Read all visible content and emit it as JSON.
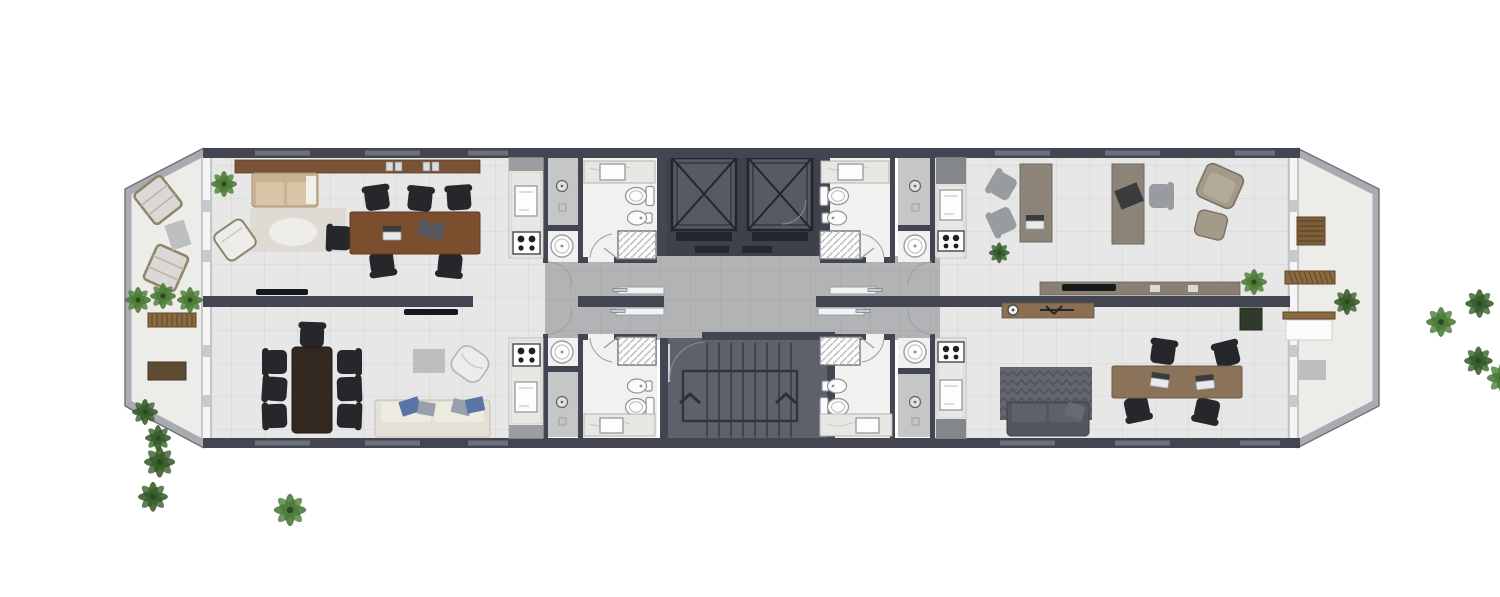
{
  "page": {
    "background": "#ffffff",
    "description": "Architectural floor plan: elongated storey with four furnished units, central double elevator core, stairwell, shared corridor with sliding entry doors, wet cores (kitchenettes, showers, WCs) flanking the core, and chamfered open terraces at both ends."
  },
  "colors": {
    "wall": "#434650",
    "wall_window": "#6d717c",
    "unit_floor": "#e6e7e6",
    "wet_floor": "#f1f1f0",
    "wet_gray": "#c5c6c6",
    "corridor_floor": "#b1b3b5",
    "terrace_floor": "#ecece9",
    "parapet": "#a9abb0",
    "parapet_edge": "#6e7076",
    "core_bg": "#3e414a",
    "cab_fill": "#575a63",
    "cab_line": "#23252c",
    "stair_bg": "#5e616b",
    "stair_line": "#3a3c44",
    "glazing": "#f5f5f5",
    "glazing_frame": "#9b9da2",
    "marble": "#e9e7e3",
    "marble_vein": "#c9c7c3",
    "fixture": "#fcfcfc",
    "fixture_line": "#8f9298",
    "shelf_wood": "#7a5336",
    "table_wood": "#7b4f2e",
    "dining_wood": "#332820",
    "desk_graywood": "#8d8478",
    "desk_tan": "#8a7358",
    "console_wood": "#8a6f52",
    "credenza_wood": "#8a8072",
    "terrace_wood": "#7d5e3b",
    "bench_wood": "#8a6a42",
    "chair_black": "#26272b",
    "chair_gray": "#989ba0",
    "sofa_beige": "#c9b293",
    "sofa_beige_cushion": "#d8c5a6",
    "sofa_cream": "#e3e1d6",
    "sofa_cream_cushion": "#edebe0",
    "sofa_gray": "#53565d",
    "sofa_gray_cushion": "#5e6168",
    "pillow_blue": "#5b74a8",
    "pillow_gray": "#9aa0ab",
    "armchair_white": "#ececeb",
    "rug_light": "#dcd9d2",
    "rug_fluffy": "#efede7",
    "rug_chevron": "#63666e",
    "rug_chevron_line": "#50535a",
    "mat_gray": "#bcbec0",
    "tv_black": "#17181b",
    "plant_green": "#4e7d3a",
    "plant_dark": "#3a5f2e",
    "door_leaf": "#f2f3f4",
    "door_arc": "#9aa0a6",
    "sill_dark": "#26282f",
    "laptop_body": "#e8e9ea",
    "laptop_screen": "#3a3c40"
  },
  "zones": {
    "left_terrace": {
      "label": "left-terrace",
      "items": [
        "lounge-chair",
        "lounge-chair",
        "floor-mat",
        "bench",
        "coffee-table",
        "planting-cluster",
        "planting-row"
      ]
    },
    "unit_upper_left": {
      "label": "unit-upper-left",
      "items": [
        "wall-shelf",
        "books",
        "potted-plant",
        "sofa",
        "area-rug",
        "fluffy-rug",
        "armchair",
        "conference-table",
        "office-chairs-x6",
        "laptop",
        "tv",
        "kitchenette",
        "shower-room",
        "washbasin-room",
        "bathroom"
      ]
    },
    "unit_lower_left": {
      "label": "unit-lower-left",
      "items": [
        "dining-table",
        "dining-chairs-x7",
        "potted-plant",
        "floor-mat",
        "armchair",
        "sofa",
        "pillows",
        "tv",
        "kitchenette",
        "shower-room",
        "washbasin-room",
        "bathroom"
      ]
    },
    "central_core": {
      "label": "elevator-core",
      "elevators": 2,
      "items": [
        "elevator-cab",
        "elevator-cab",
        "service-door"
      ]
    },
    "corridor": {
      "label": "corridor",
      "sliding_doors": 4
    },
    "stairwell": {
      "label": "stairwell",
      "flights": 2,
      "items": [
        "stair-door",
        "up-arrows"
      ]
    },
    "unit_upper_right": {
      "label": "unit-upper-right",
      "items": [
        "desk",
        "desk",
        "office-chairs-gray-x3",
        "chair-black",
        "laptop",
        "armchair",
        "ottoman",
        "credenza",
        "tv",
        "potted-plant",
        "kitchenette",
        "shower-room",
        "washbasin-room",
        "bathroom"
      ]
    },
    "unit_lower_right": {
      "label": "unit-lower-right",
      "items": [
        "coffee-console",
        "coffee-machine",
        "chevron-rug",
        "sofa",
        "desk",
        "office-chairs-x4",
        "laptops-x2",
        "potted-plant",
        "kitchenette",
        "shower-room",
        "washbasin-room",
        "bathroom"
      ]
    },
    "right_terrace": {
      "label": "right-terrace",
      "items": [
        "slatted-table",
        "bench",
        "bench",
        "white-table",
        "floor-mat",
        "planter-box",
        "shrub-row",
        "potted-plant"
      ]
    }
  }
}
